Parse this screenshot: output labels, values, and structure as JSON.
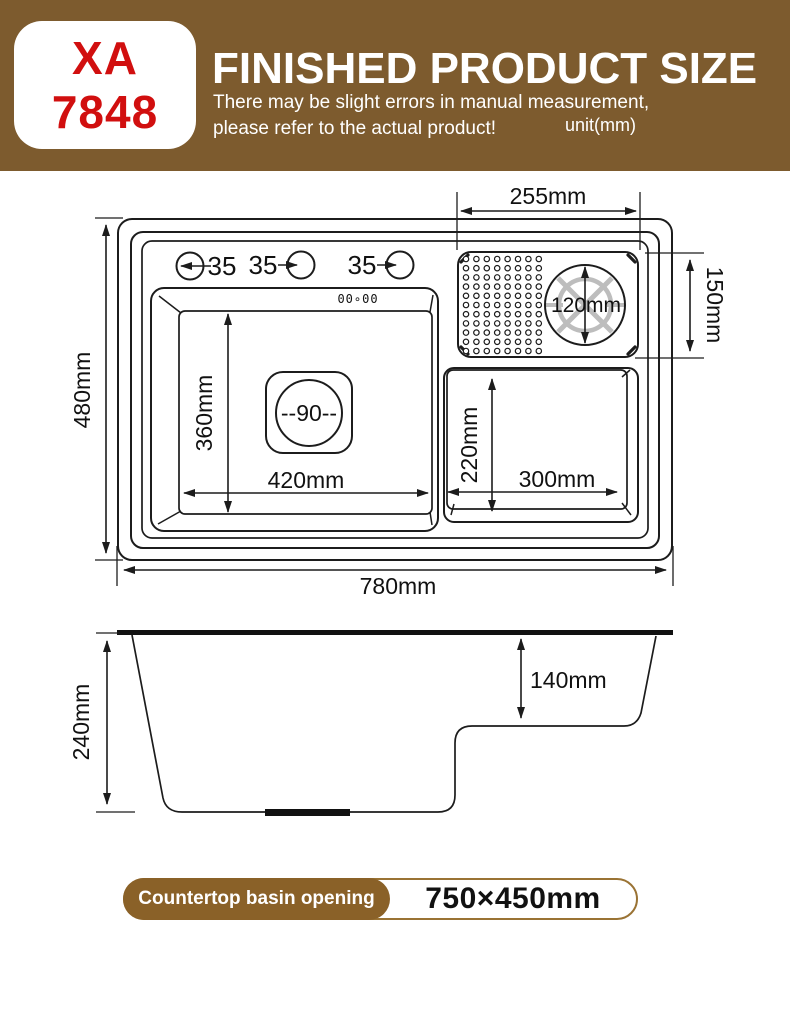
{
  "header": {
    "model": {
      "line1": "XA",
      "line2": "7848"
    },
    "title": "FINISHED PRODUCT SIZE",
    "subtitle_line1": "There may be slight errors in manual measurement,",
    "subtitle_line2": "please refer to the actual product!",
    "unit_label": "unit(mm)",
    "colors": {
      "background": "#7d5b2e",
      "model_text": "#d10f0f",
      "title_text": "#ffffff"
    }
  },
  "top_view": {
    "dims": {
      "overall_width": "780mm",
      "overall_depth": "480mm",
      "main_basin_width": "420mm",
      "main_basin_depth": "360mm",
      "small_basin_width": "300mm",
      "small_basin_depth": "220mm",
      "tray_width": "255mm",
      "tray_depth": "150mm",
      "strainer_diameter": "120mm",
      "drain_label": "--90--"
    },
    "faucet_holes": [
      "35",
      "35",
      "35"
    ],
    "display_text": "00∘00"
  },
  "side_view": {
    "dims": {
      "total_depth": "240mm",
      "bowl_step_depth": "140mm"
    }
  },
  "footer": {
    "label": "Countertop basin opening",
    "value": "750×450mm",
    "colors": {
      "pill_brown": "#8a6128",
      "pill_border": "#9a7334"
    }
  }
}
